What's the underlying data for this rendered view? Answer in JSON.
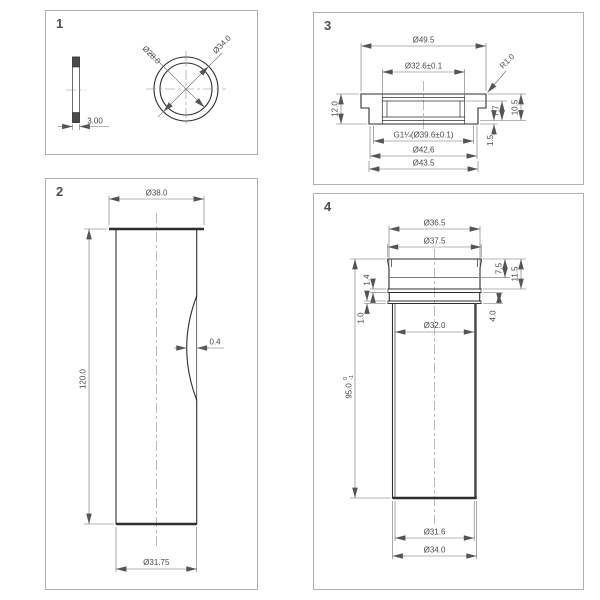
{
  "sheet": {
    "background": "#ffffff",
    "panel_border_color": "#b0b0b0",
    "object_line_color": "#2f2f2f",
    "dimension_color": "#4a4a4a"
  },
  "panels": {
    "p1": {
      "num": "1",
      "dim_inner_dia": "Ø28.0",
      "dim_outer_dia": "Ø34.0",
      "dim_thickness": "3.00"
    },
    "p2": {
      "num": "2",
      "dim_top_dia": "Ø38.0",
      "dim_length": "120.0",
      "dim_wall": "0.4",
      "dim_bottom_dia": "Ø31.75"
    },
    "p3": {
      "num": "3",
      "dim_outer_dia": "Ø49.5",
      "dim_bore_dia": "Ø32.6±0.1",
      "dim_radius": "R1.0",
      "dim_height": "12.0",
      "dim_depth_inner": "7.7",
      "dim_depth_outer": "10.5",
      "dim_lip": "1.5",
      "dim_thread": "G1¼(Ø39.6±0.1)",
      "dim_d42": "Ø42,6",
      "dim_d43": "Ø43.5"
    },
    "p4": {
      "num": "4",
      "dim_top_dia1": "Ø36.5",
      "dim_top_dia2": "Ø37.5",
      "dim_length": "95.0",
      "dim_length_tol_upper": "0",
      "dim_length_tol_lower": "-1",
      "dim_bore": "Ø32.0",
      "dim_rim_h1": "7.5",
      "dim_rim_h2": "11.5",
      "dim_rib_span": "4.0",
      "dim_rib1": "1.4",
      "dim_rib2": "1.0",
      "dim_bottom_id": "Ø31.6",
      "dim_bottom_od": "Ø34.0"
    }
  }
}
